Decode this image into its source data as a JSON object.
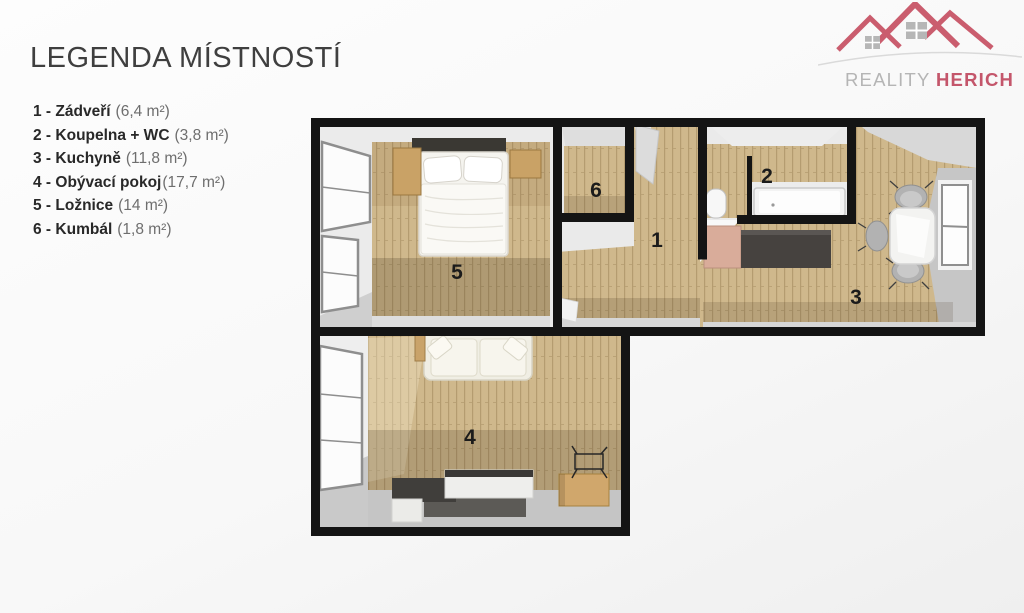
{
  "header": {
    "title": "LEGENDA MÍSTNOSTÍ"
  },
  "logo": {
    "name_gray": "REALITY",
    "name_red": "HERICH"
  },
  "legend": {
    "items": [
      {
        "prefix": "1 -",
        "name": "Zádveří",
        "area": "(6,4 m²)"
      },
      {
        "prefix": "2 -",
        "name": "Koupelna + WC",
        "area": "(3,8 m²)"
      },
      {
        "prefix": "3 -",
        "name": "Kuchyně",
        "area": "(11,8 m²)"
      },
      {
        "prefix": "4 -",
        "name": "Obývací pokoj",
        "area": "(17,7 m²)"
      },
      {
        "prefix": "5 -",
        "name": "Ložnice",
        "area": "(14 m²)"
      },
      {
        "prefix": "6 -",
        "name": "Kumbál",
        "area": "(1,8 m²)"
      }
    ]
  },
  "plan": {
    "room_numbers": {
      "hall": "1",
      "bath": "2",
      "kitchen": "3",
      "living": "4",
      "bedroom": "5",
      "closet": "6"
    }
  },
  "colors": {
    "accent_red": "#c4566b",
    "wood": "#cfb88c",
    "wall": "#141414"
  }
}
